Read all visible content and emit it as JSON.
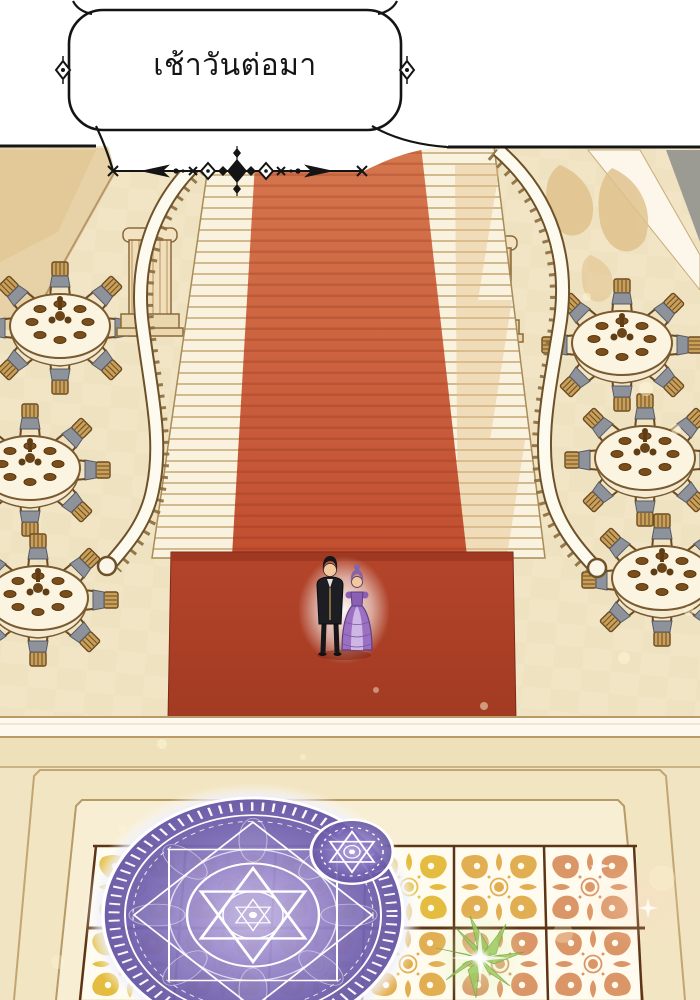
{
  "caption": {
    "text": "เช้าวันต่อมา"
  },
  "palette": {
    "panel_white": "#ffffff",
    "ink_line": "#141414",
    "floor_beige": "#f1e5c6",
    "floor_check": "#e7d6ab",
    "wall_tan": "#e7d2a7",
    "shadow_tan": "#dfc08a",
    "stair_cream": "#f9f2df",
    "stair_tread_line": "#d3ba8e",
    "rail_white": "#fdfaf0",
    "rail_outline": "#6e5128",
    "carpet_top": "#d6774e",
    "carpet_bottom": "#c14e30",
    "carpet_landing": "#ac3e25",
    "table_cloth": "#fbf4e1",
    "chair_wood": "#c9a05a",
    "chair_cushion": "#8e939b",
    "food_brown": "#6b4418",
    "tile_white": "#fffcef",
    "tile_gold": "#e4bd40",
    "tile_pink": "#db9668",
    "tile_grout": "#5d3414",
    "magic_purple": "#7d6ab8",
    "magic_lines": "#ffffff",
    "sparkle_green": "#9ccb62",
    "suit_black": "#1d1d24",
    "gown_purple": "#9b6fc2",
    "skin": "#f1c8a0"
  },
  "scene": {
    "elements": [
      "speech-caption",
      "ornament-divider",
      "grand-staircase",
      "red-carpet",
      "banquet-tables",
      "columns",
      "noble-couple",
      "magic-circle",
      "ornate-tile-floor",
      "green-sparkle"
    ]
  }
}
